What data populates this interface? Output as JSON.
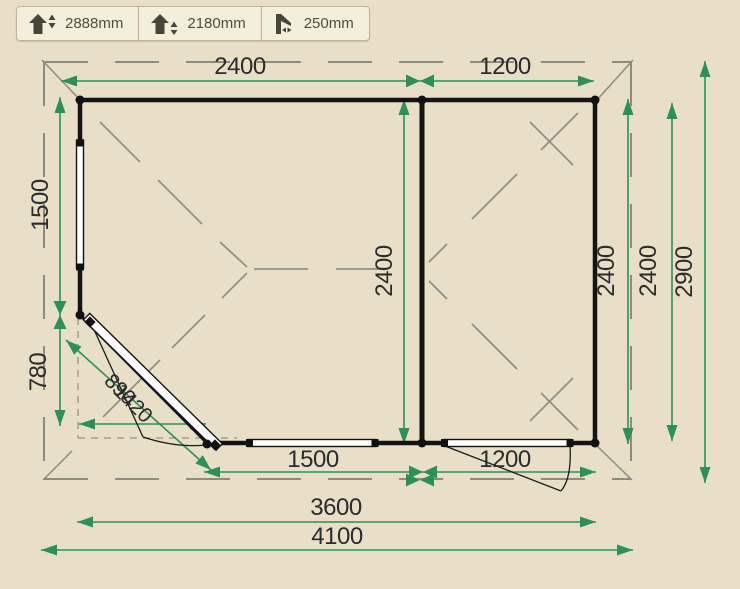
{
  "colors": {
    "background": "#e7dfc8",
    "dimension_green": "#2f8f58",
    "wall_black": "#141414",
    "roof_gray": "#8f8a7d"
  },
  "toolbar": {
    "buttons": [
      {
        "name": "ridge-height",
        "value": "2888mm"
      },
      {
        "name": "eaves-height",
        "value": "2180mm"
      },
      {
        "name": "roof-overhang",
        "value": "250mm"
      }
    ]
  },
  "plan": {
    "dimensions": {
      "top_left_width": "2400",
      "top_right_width": "1200",
      "left_upper_height": "1500",
      "left_corner_height": "780",
      "inner_depth": "2400",
      "right_inner_depth": "2400",
      "right_wall_depth": "2400",
      "overall_depth": "2900",
      "bottom_left_width": "1500",
      "bottom_right_width": "1200",
      "total_wall_width": "3600",
      "overall_width": "4100",
      "corner_door_width": "1420",
      "corner_cut_width": "890"
    }
  }
}
